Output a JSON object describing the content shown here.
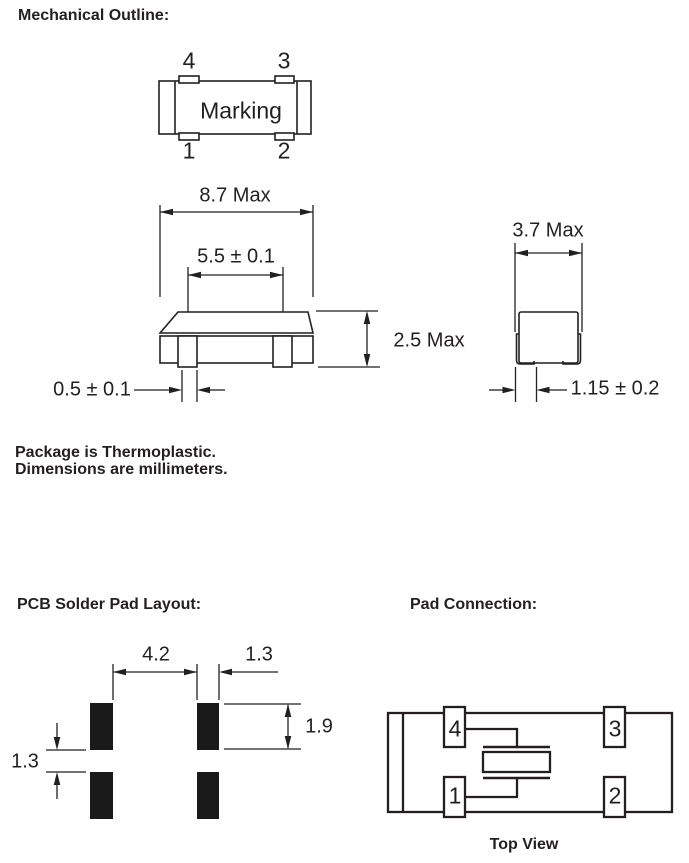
{
  "headings": {
    "mechanical": "Mechanical Outline:",
    "pcb_layout": "PCB Solder Pad Layout:",
    "pad_connection": "Pad Connection:",
    "top_view_caption": "Top View"
  },
  "notes": {
    "line1": "Package is Thermoplastic.",
    "line2": "Dimensions are millimeters."
  },
  "package_top_view": {
    "marking": "Marking",
    "pin_top_left": "4",
    "pin_top_right": "3",
    "pin_bottom_left": "1",
    "pin_bottom_right": "2"
  },
  "front_view_dims": {
    "overall_width": "8.7 Max",
    "lid_width": "5.5 ± 0.1",
    "overall_height": "2.5 Max",
    "lead_width": "0.5 ± 0.1"
  },
  "side_view_dims": {
    "overall_depth": "3.7 Max",
    "pad_depth": "1.15 ± 0.2"
  },
  "pcb_pad_dims": {
    "horizontal_gap": "4.2",
    "pad_width": "1.3",
    "pad_height": "1.9",
    "vertical_gap": "1.3"
  },
  "pad_connection_pins": {
    "pin_top_left": "4",
    "pin_top_right": "3",
    "pin_bottom_left": "1",
    "pin_bottom_right": "2"
  },
  "colors": {
    "ink": "#231f20",
    "background": "#ffffff",
    "pcb_pad_fill": "#1a1a1a"
  }
}
